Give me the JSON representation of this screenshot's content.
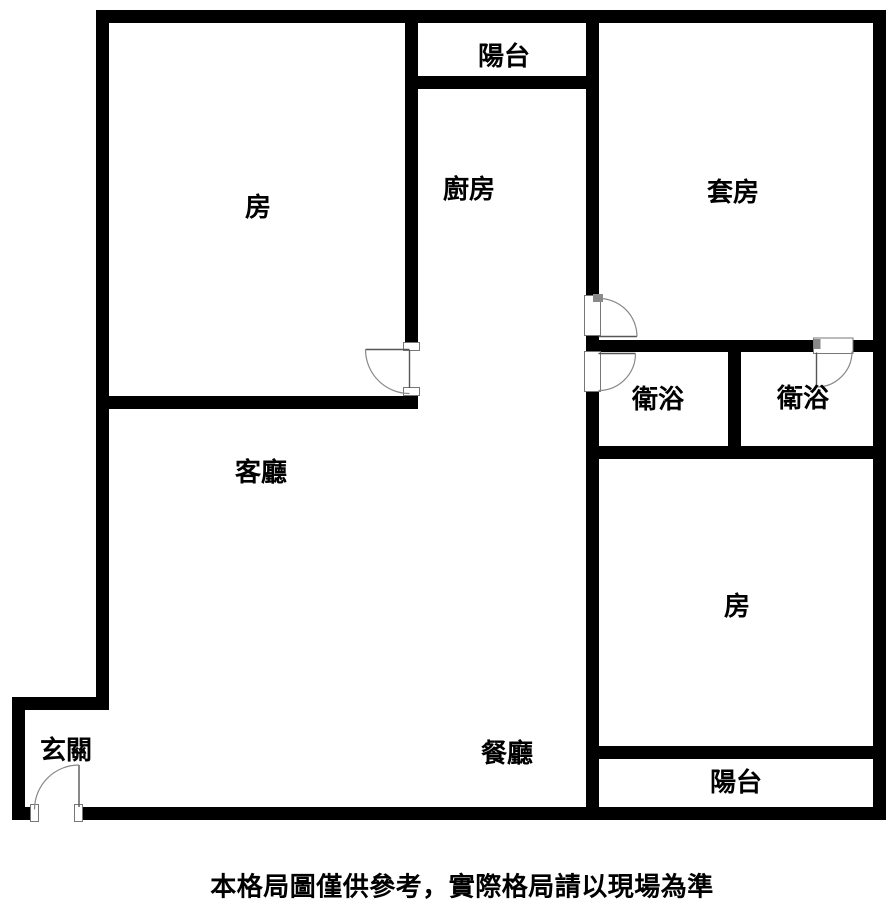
{
  "plan": {
    "rooms": [
      {
        "name": "bedroom-top-left",
        "label": "房"
      },
      {
        "name": "balcony-top",
        "label": "陽台"
      },
      {
        "name": "kitchen",
        "label": "廚房"
      },
      {
        "name": "master-suite",
        "label": "套房"
      },
      {
        "name": "bathroom-left",
        "label": "衛浴"
      },
      {
        "name": "bathroom-right",
        "label": "衛浴"
      },
      {
        "name": "living-room",
        "label": "客廳"
      },
      {
        "name": "bedroom-bottom-right",
        "label": "房"
      },
      {
        "name": "dining-room",
        "label": "餐廳"
      },
      {
        "name": "balcony-bottom",
        "label": "陽台"
      },
      {
        "name": "entryway",
        "label": "玄關"
      }
    ],
    "disclaimer": "本格局圖僅供參考，實際格局請以現場為準",
    "colors": {
      "wall": "#000000",
      "background": "#ffffff",
      "door": "#888888",
      "text": "#000000"
    }
  }
}
